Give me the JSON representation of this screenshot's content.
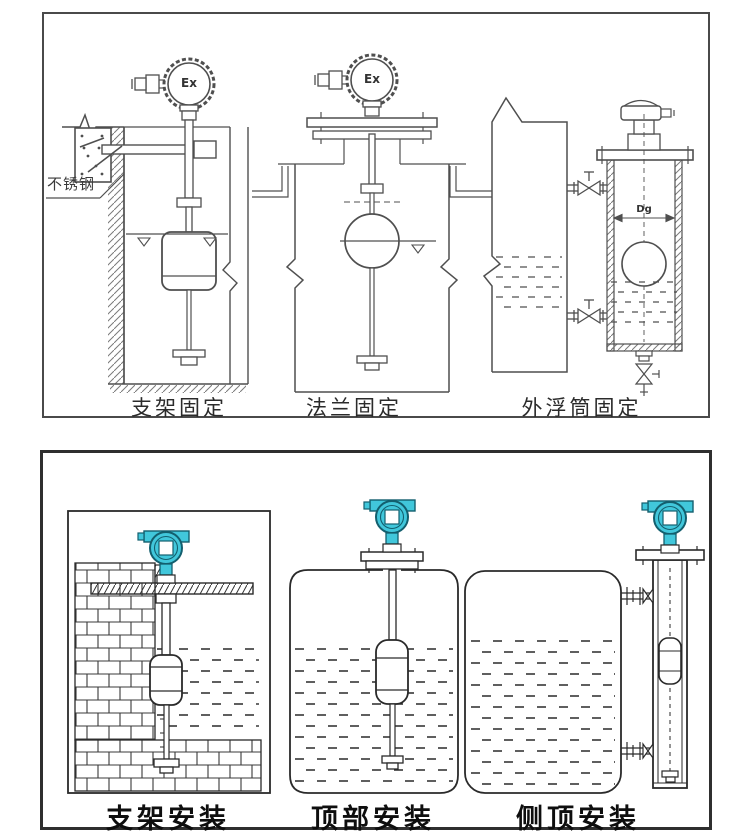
{
  "page": {
    "background": "#ffffff",
    "line_color_top": "#4f4f4f",
    "line_color_bottom": "#2a2a2a",
    "teal_fill": "#41c7db",
    "teal_outline": "#135f6e"
  },
  "top_panel": {
    "figures": [
      {
        "id": "bracket-fixing",
        "label": "支架固定",
        "head_text": "Ex",
        "annotation": "不锈钢"
      },
      {
        "id": "flange-fixing",
        "label": "法兰固定",
        "head_text": "Ex"
      },
      {
        "id": "external-chamber-fixing",
        "label": "外浮筒固定",
        "dimension_label": "Dg"
      }
    ]
  },
  "bottom_panel": {
    "figures": [
      {
        "id": "bracket-installation",
        "label": "支架安装"
      },
      {
        "id": "top-installation",
        "label": "顶部安装"
      },
      {
        "id": "side-top-installation",
        "label": "侧顶安装"
      }
    ]
  }
}
